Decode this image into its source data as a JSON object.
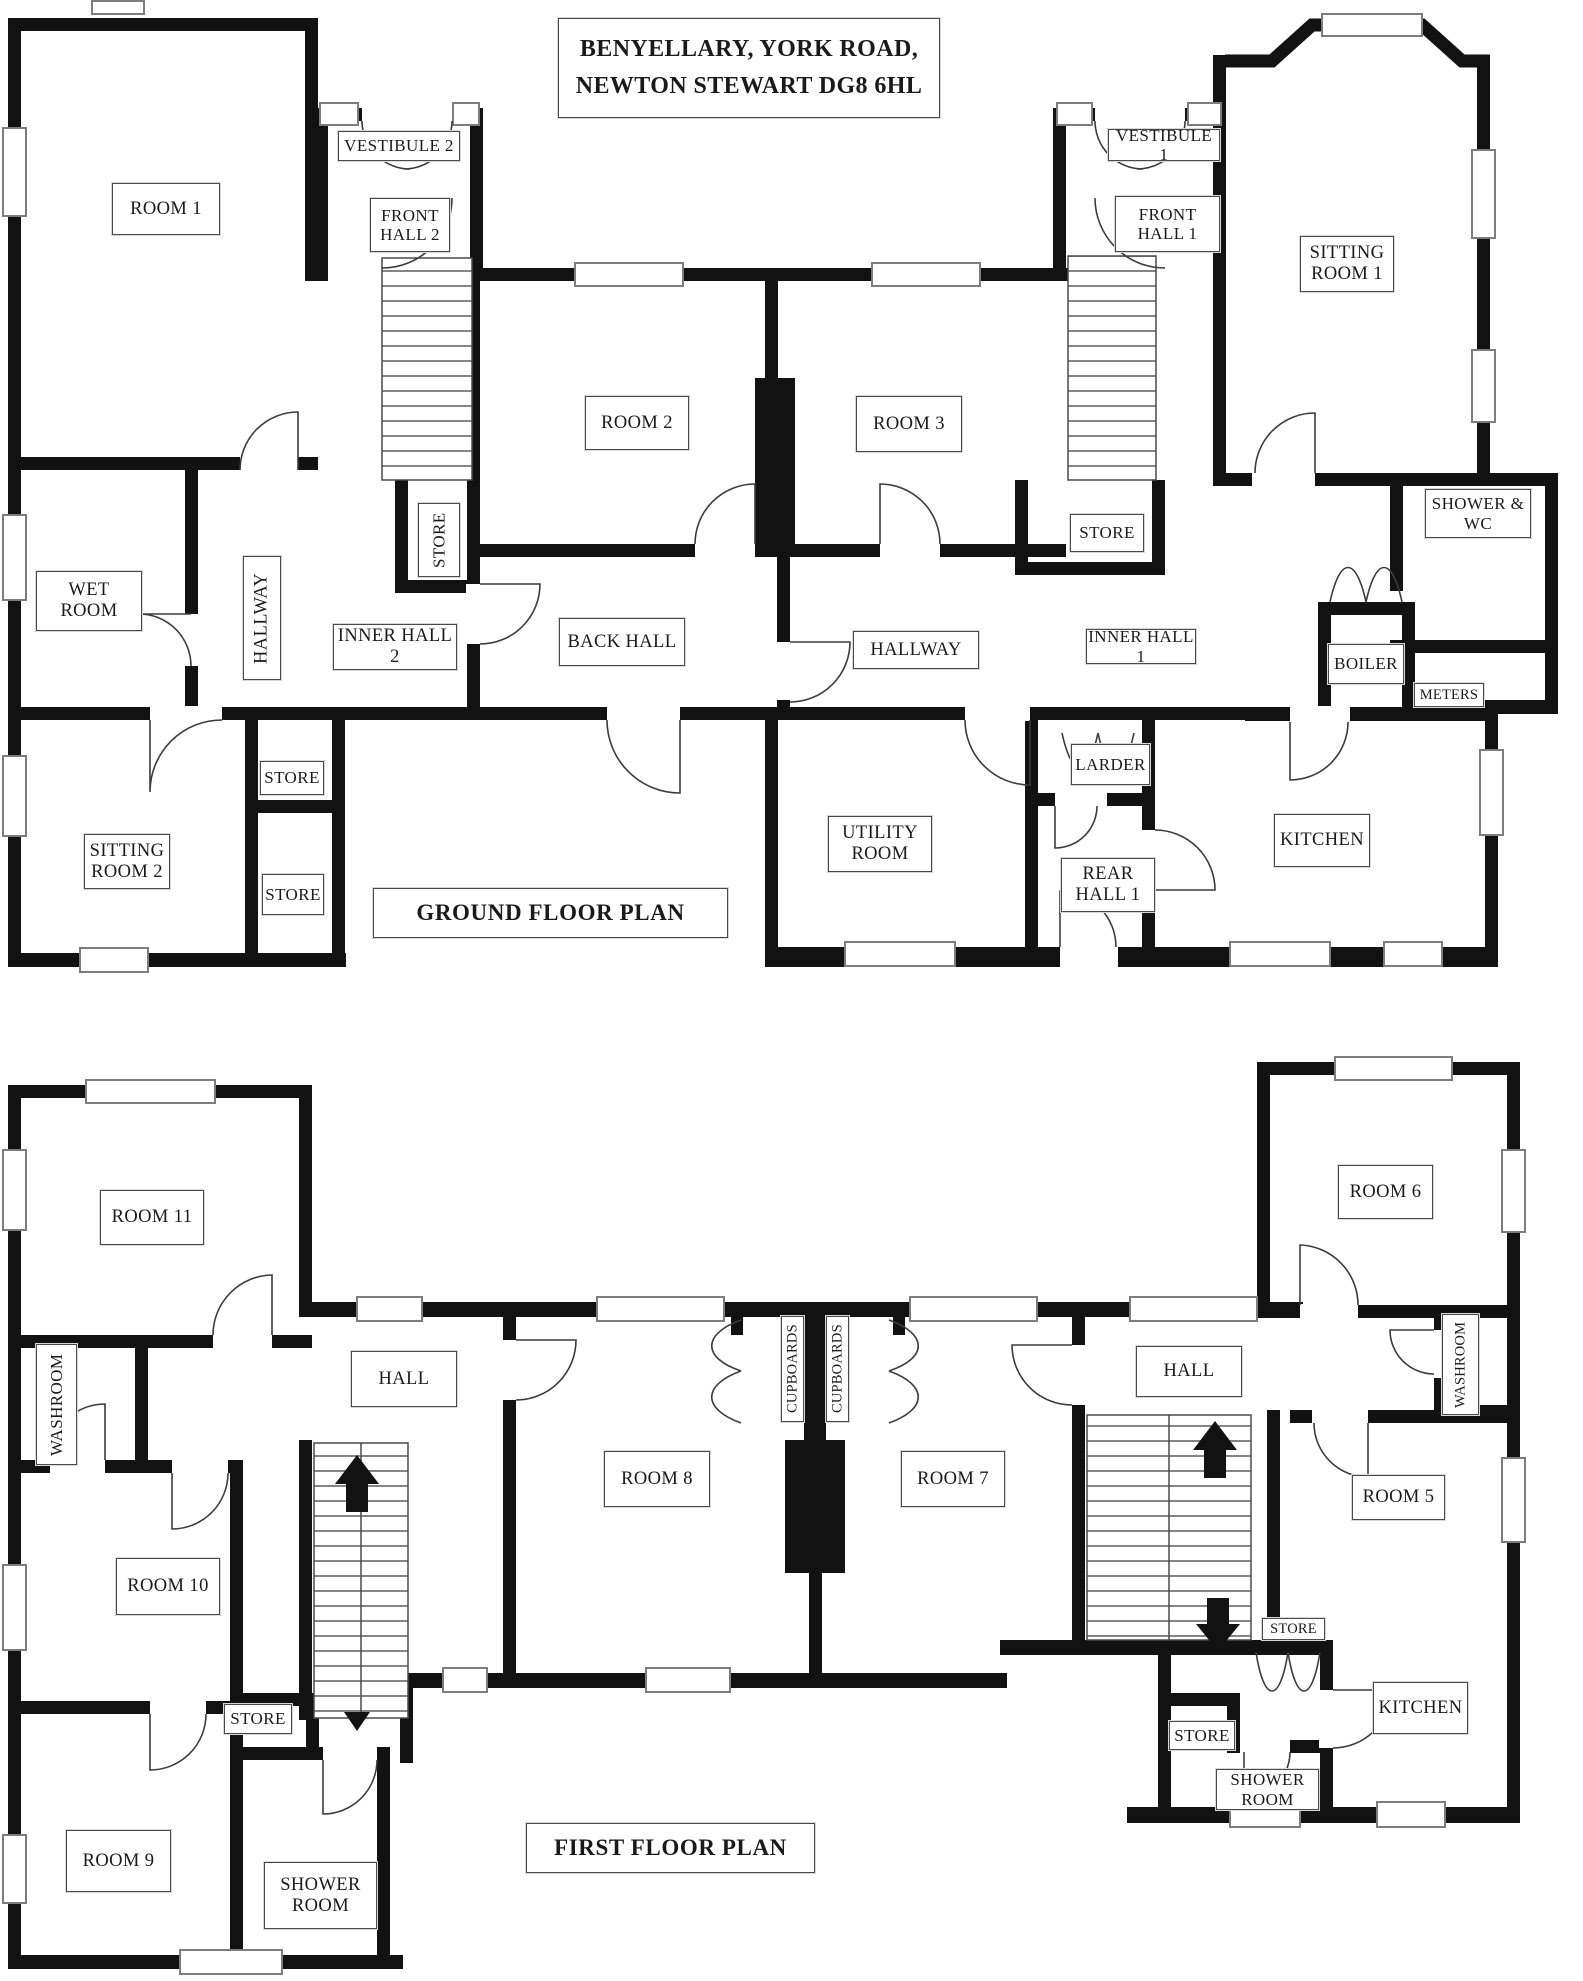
{
  "title": {
    "line1": "BENYELLARY, YORK ROAD,",
    "line2": "NEWTON STEWART DG8 6HL"
  },
  "ground": {
    "caption": "GROUND FLOOR PLAN",
    "rooms": {
      "room1": "ROOM 1",
      "vestibule2": "VESTIBULE 2",
      "front_hall2": "FRONT HALL 2",
      "room2": "ROOM 2",
      "room3": "ROOM 3",
      "vestibule1": "VESTIBULE 1",
      "front_hall1": "FRONT HALL 1",
      "sitting_room1": "SITTING ROOM 1",
      "wet_room": "WET ROOM",
      "hallway_left": "HALLWAY",
      "inner_hall2": "INNER HALL 2",
      "store_stairs2": "STORE",
      "back_hall": "BACK HALL",
      "hallway_right": "HALLWAY",
      "store_stairs1": "STORE",
      "inner_hall1": "INNER HALL 1",
      "shower_wc": "SHOWER & WC",
      "boiler": "BOILER",
      "meters": "METERS",
      "larder": "LARDER",
      "sitting_room2": "SITTING ROOM 2",
      "store_a": "STORE",
      "store_b": "STORE",
      "utility_room": "UTILITY ROOM",
      "rear_hall1": "REAR HALL 1",
      "kitchen": "KITCHEN"
    }
  },
  "first": {
    "caption": "FIRST FLOOR PLAN",
    "rooms": {
      "room11": "ROOM 11",
      "washroom_left": "WASHROOM",
      "hall_left": "HALL",
      "room10": "ROOM 10",
      "store_left": "STORE",
      "room9": "ROOM 9",
      "shower_room_left": "SHOWER ROOM",
      "room8": "ROOM 8",
      "cupboards_a": "CUPBOARDS",
      "cupboards_b": "CUPBOARDS",
      "room7": "ROOM 7",
      "hall_right": "HALL",
      "room6": "ROOM 6",
      "washroom_right": "WASHROOM",
      "room5": "ROOM 5",
      "store_right_upper": "STORE",
      "store_right_lower": "STORE",
      "kitchen": "KITCHEN",
      "shower_room_right": "SHOWER ROOM"
    }
  }
}
